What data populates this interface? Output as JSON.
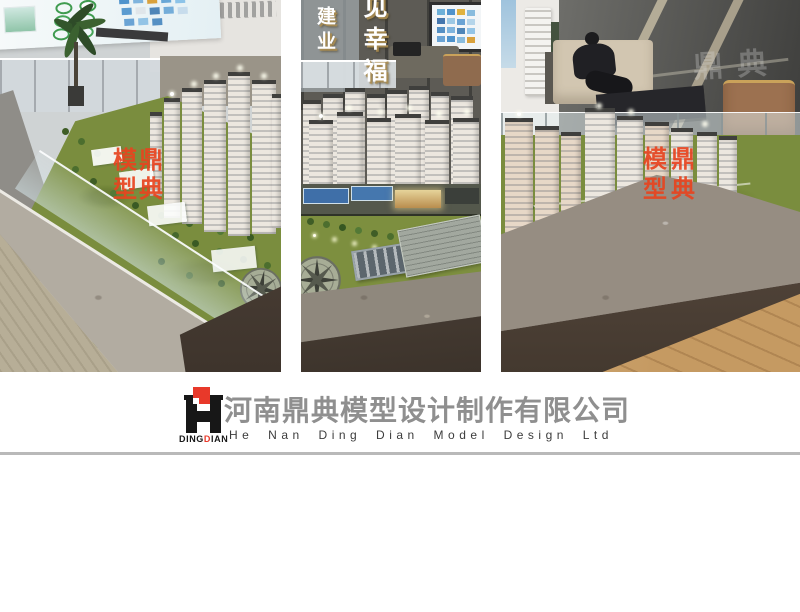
{
  "branding": {
    "logo": {
      "wordmark_parts": [
        {
          "text": "DING"
        },
        {
          "text": "D"
        },
        {
          "text": "IAN"
        }
      ],
      "red": "#e8392a",
      "black": "#171717"
    },
    "company_name_cn": "河南鼎典模型设计制作有限公司",
    "company_name_en": "He Nan Ding Dian Model Design Ltd"
  },
  "watermarks": {
    "seal_text": "鼎典模型",
    "seal_chars": [
      "模",
      "鼎",
      "型",
      "典"
    ],
    "seal_color": "#e8441f",
    "window_watermark": "鼎典"
  },
  "photo_middle_signs": {
    "left_vertical_sign": "建业",
    "right_vertical_sign": "见幸福"
  },
  "palette": {
    "lawn_green": "#7a8d3e",
    "tower_white": "#e9e4da",
    "marble_top_light": "#b2aca1",
    "marble_top_mid": "#8f887d",
    "marble_face_dark": "#4a3e36",
    "wood_floor_left": "#b7ae97",
    "wood_floor_right": "#c59a62",
    "court_blue": "#3f6fa8",
    "divider_gray": "#b9b9b9",
    "company_cn_gray": "#8f8f8f"
  }
}
